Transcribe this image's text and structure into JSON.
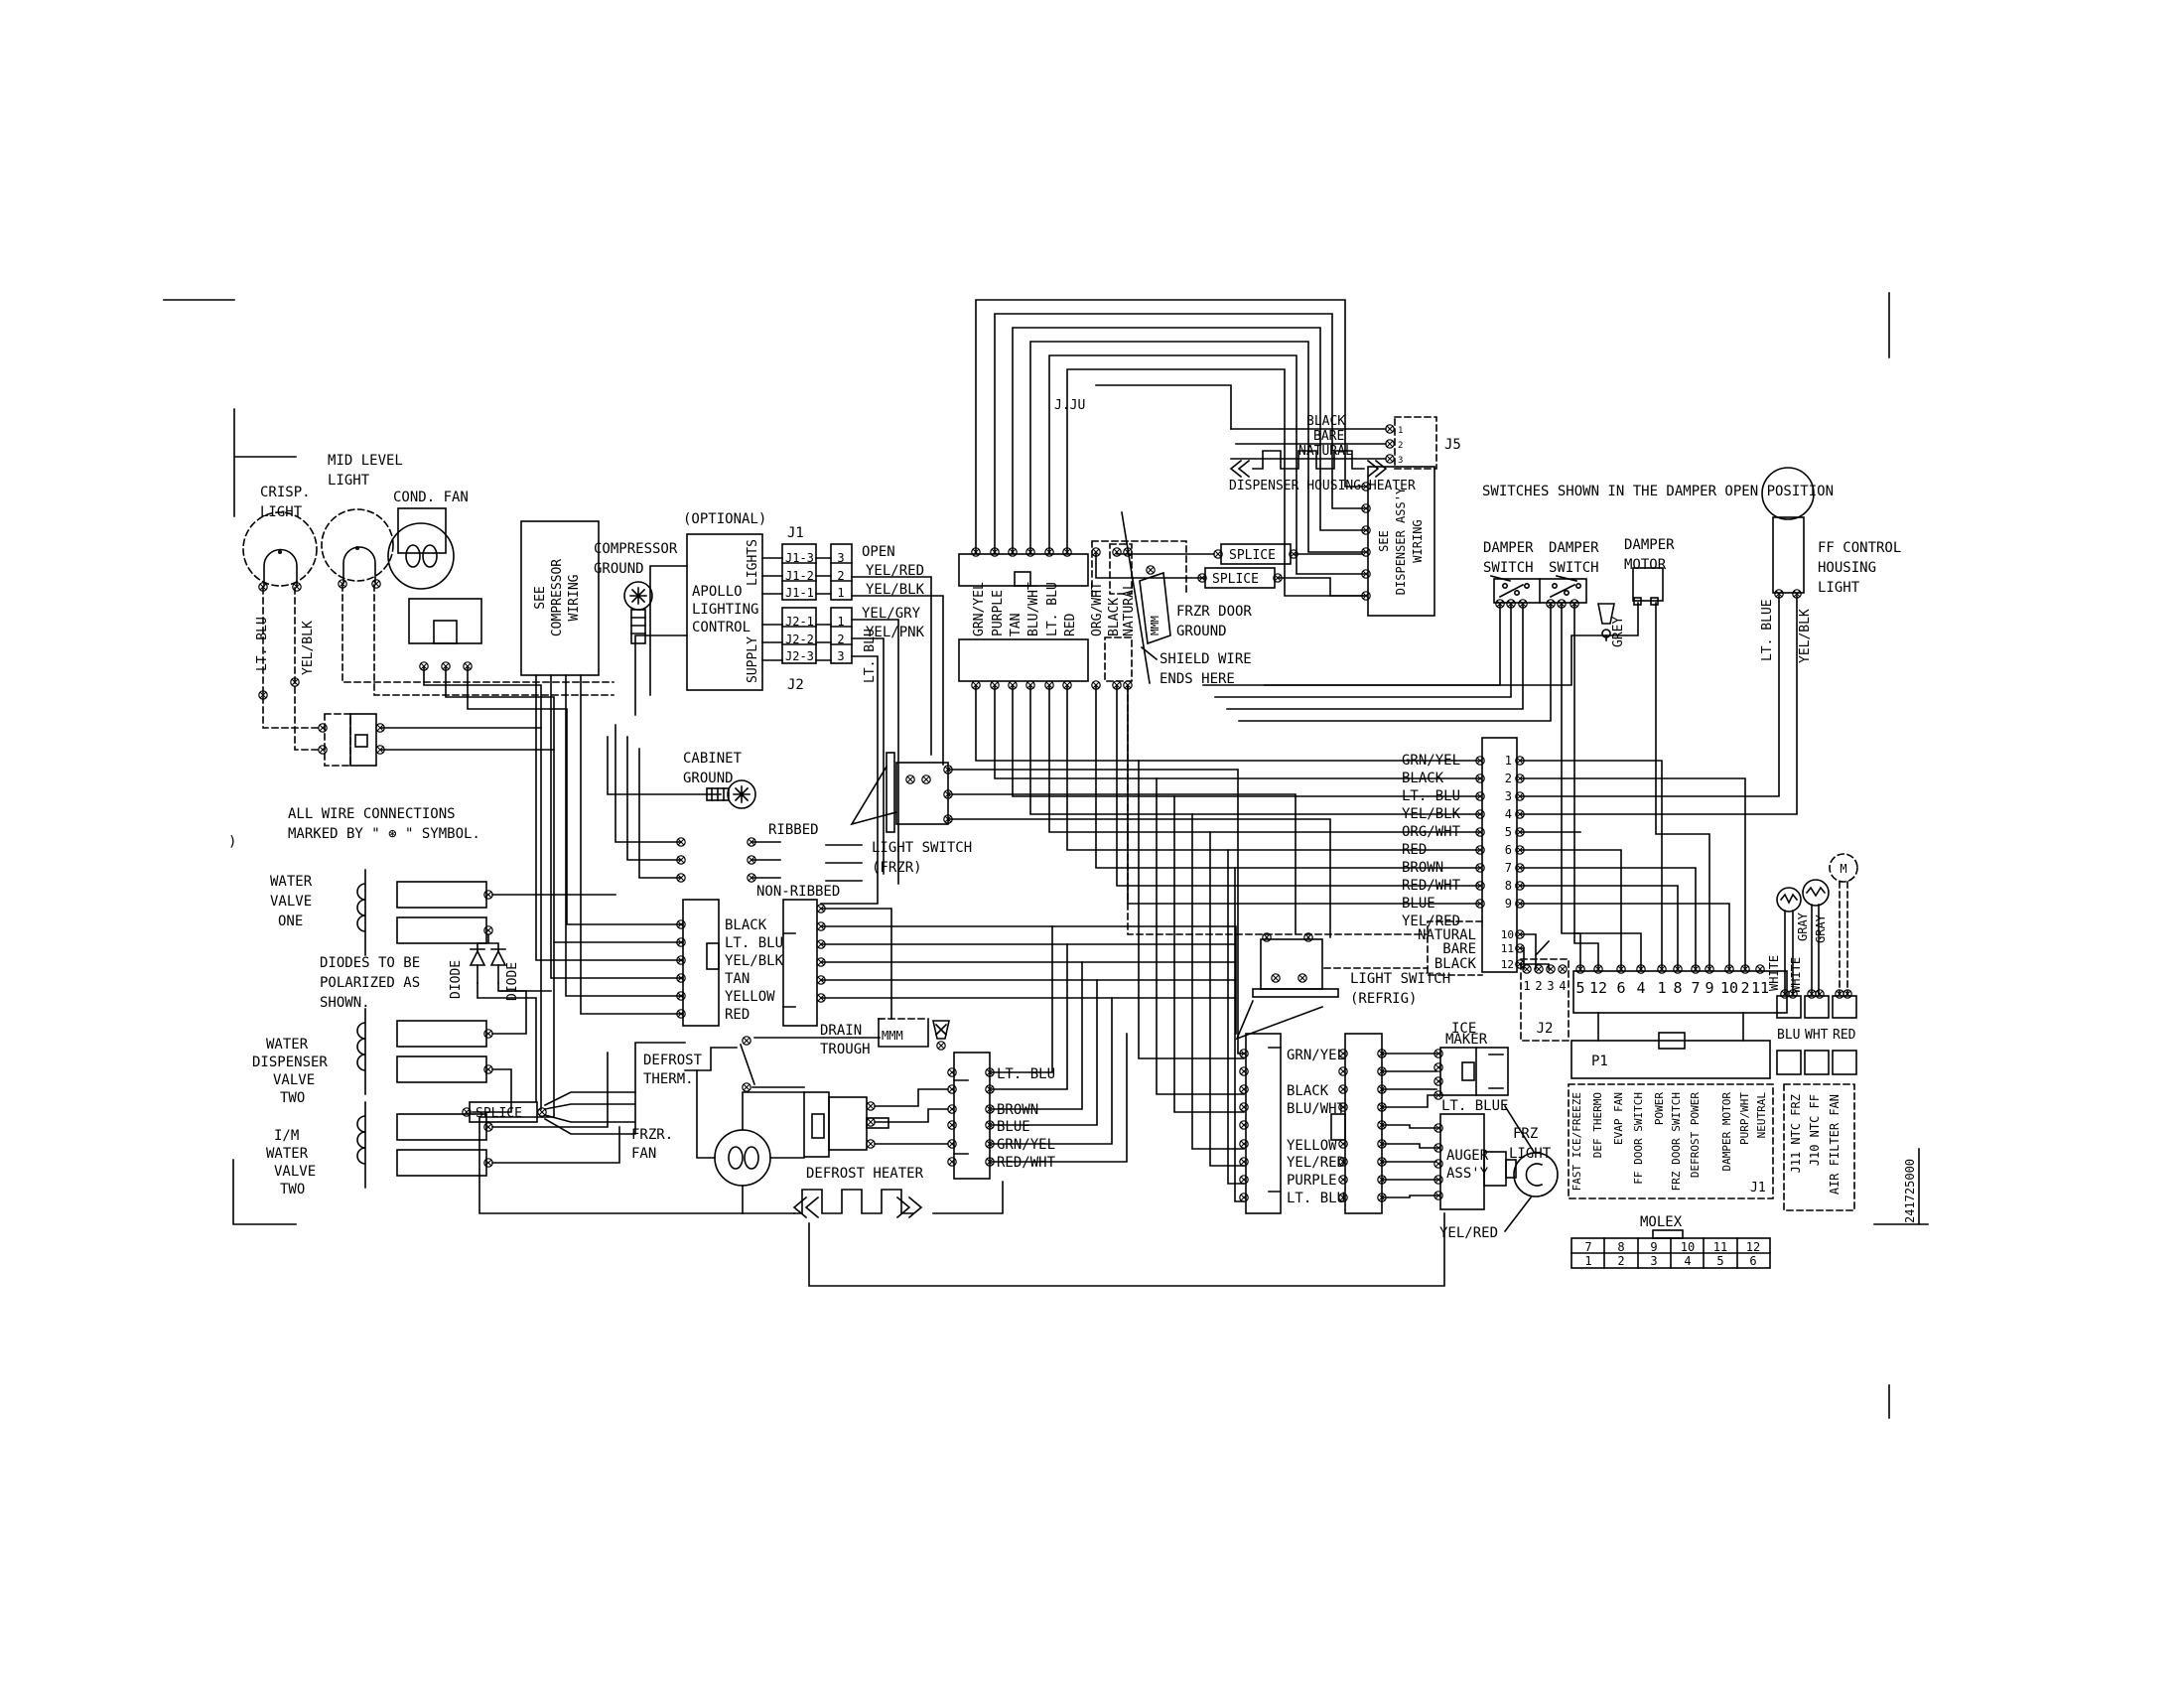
{
  "meta": {
    "ink_color": "#000000",
    "paper_color": "#ffffff",
    "part_number": "241725000",
    "clipped_text": "J.JU"
  },
  "notes": {
    "switches_note": "SWITCHES SHOWN IN THE DAMPER OPEN POSITION",
    "all_wire": [
      "ALL WIRE CONNECTIONS",
      "MARKED BY \" ⊛ \" SYMBOL."
    ],
    "diodes": [
      "DIODES TO BE",
      "POLARIZED AS",
      "SHOWN."
    ],
    "stray_paren": ")"
  },
  "components": {
    "crisp_light": [
      "CRISP.",
      "LIGHT"
    ],
    "mid_level_light": [
      "MID LEVEL",
      "LIGHT"
    ],
    "cond_fan": "COND. FAN",
    "compressor_box": [
      "SEE",
      "COMPRESSOR",
      "WIRING"
    ],
    "compressor_ground": [
      "COMPRESSOR",
      "GROUND"
    ],
    "optional": "(OPTIONAL)",
    "apollo": [
      "APOLLO",
      "LIGHTING",
      "CONTROL"
    ],
    "lights": "LIGHTS",
    "supply": "SUPPLY",
    "cabinet_ground": [
      "CABINET",
      "GROUND"
    ],
    "ribbed": "RIBBED",
    "non_ribbed": "NON-RIBBED",
    "light_switch_frzr": [
      "LIGHT SWITCH",
      "(FRZR)"
    ],
    "light_switch_refrig": [
      "LIGHT SWITCH",
      "(REFRIG)"
    ],
    "drain_trough": [
      "DRAIN",
      "TROUGH"
    ],
    "defrost_therm": [
      "DEFROST",
      "THERM."
    ],
    "frzr_fan": [
      "FRZR.",
      "FAN"
    ],
    "defrost_heater": "DEFROST HEATER",
    "water_valve_one": [
      "WATER",
      "VALVE",
      "ONE"
    ],
    "water_dispenser_valve_two": [
      "WATER",
      "DISPENSER",
      "VALVE",
      "TWO"
    ],
    "im_water_valve_two": [
      "I/M",
      "WATER",
      "VALVE",
      "TWO"
    ],
    "frzr_door_ground": [
      "FRZR DOOR",
      "GROUND"
    ],
    "shield_wire": [
      "SHIELD WIRE",
      "ENDS HERE"
    ],
    "dispenser_housing_heater": "DISPENSER HOUSING HEATER",
    "see_dispenser": [
      "SEE",
      "DISPENSER ASS'Y",
      "WIRING"
    ],
    "damper_switch": [
      "DAMPER",
      "SWITCH"
    ],
    "damper_motor": [
      "DAMPER",
      "MOTOR"
    ],
    "ff_control": [
      "FF CONTROL",
      "HOUSING",
      "LIGHT"
    ],
    "ice_maker": [
      "ICE",
      "MAKER"
    ],
    "auger": [
      "AUGER",
      "ASS'Y"
    ],
    "frz_light": [
      "FRZ",
      "LIGHT"
    ],
    "motor_m": "M",
    "mmm": "MMM",
    "splice": "SPLICE"
  },
  "connectors": {
    "j1_title": "J1",
    "j2_title": "J2",
    "j5_title": "J5",
    "p1": "P1",
    "j1_label": "J1",
    "j2_conn": "J2",
    "molex": "MOLEX",
    "j1_rows": [
      "J1-3",
      "J1-2",
      "J1-1"
    ],
    "j1_nums": [
      "3",
      "2",
      "1"
    ],
    "j2_rows": [
      "J2-1",
      "J2-2",
      "J2-3"
    ],
    "j2_nums": [
      "1",
      "2",
      "3"
    ],
    "j5_wires": [
      "BLACK",
      "BARE",
      "NATURAL"
    ],
    "j5_nums": [
      "1",
      "2",
      "3"
    ],
    "main_wires": [
      "GRN/YEL",
      "BLACK",
      "LT. BLU",
      "YEL/BLK",
      "ORG/WHT",
      "RED",
      "BROWN",
      "RED/WHT",
      "BLUE",
      "YEL/RED"
    ],
    "main_dashed_wires": [
      "NATURAL",
      "BARE",
      "BLACK"
    ],
    "main_nums": [
      "1",
      "2",
      "3",
      "4",
      "5",
      "6",
      "7",
      "8",
      "9"
    ],
    "main_dashed_nums": [
      "10",
      "11",
      "12"
    ],
    "j2_conn_nums": [
      "1",
      "2",
      "3",
      "4"
    ],
    "long_nums": [
      "5",
      "12",
      "6",
      "4",
      "1",
      "8",
      "7",
      "9",
      "10",
      "2",
      "11"
    ],
    "j1_conn_labels": [
      "FAST ICE/FREEZE",
      "DEF THERMO",
      "EVAP FAN",
      "FF DOOR SWITCH",
      "POWER",
      "FRZ DOOR SWITCH",
      "DEFROST POWER",
      "DAMPER MOTOR",
      "PURP/WHT",
      "NEUTRAL"
    ],
    "ntc_labels": [
      "J11 NTC FRZ",
      "J10 NTC FF",
      "AIR FILTER FAN"
    ],
    "molex_top": [
      "7",
      "8",
      "9",
      "10",
      "11",
      "12"
    ],
    "molex_bottom": [
      "1",
      "2",
      "3",
      "4",
      "5",
      "6"
    ]
  },
  "wire_labels": {
    "lt_blu": "LT. BLU",
    "yel_blk": "YEL/BLK",
    "open": "OPEN",
    "yel_red": "YEL/RED",
    "yel_gry": "YEL/GRY",
    "yel_pnk": "YEL/PNK",
    "disp_conn": [
      "GRN/YEL",
      "PURPLE",
      "TAN",
      "BLU/WHT",
      "LT. BLU",
      "RED",
      "ORG/WHT",
      "BLACK",
      "NATURAL"
    ],
    "small_conn": [
      "BLACK",
      "LT. BLU",
      "YEL/BLK",
      "TAN",
      "YELLOW",
      "RED"
    ],
    "evap_conn": [
      "LT. BLU",
      "BROWN",
      "BLUE",
      "GRN/YEL",
      "RED/WHT"
    ],
    "freezer_conn": [
      "GRN/YEL",
      "BLACK",
      "BLU/WHT",
      "YELLOW",
      "YEL/RED",
      "PURPLE",
      "LT. BLU"
    ],
    "grey": "GREY",
    "lt_blue": "LT. BLUE",
    "white": "WHITE",
    "gray": "GRAY",
    "blu": "BLU",
    "wht": "WHT",
    "red": "RED",
    "yel_red_callout": "YEL/RED",
    "diode": "DIODE"
  }
}
